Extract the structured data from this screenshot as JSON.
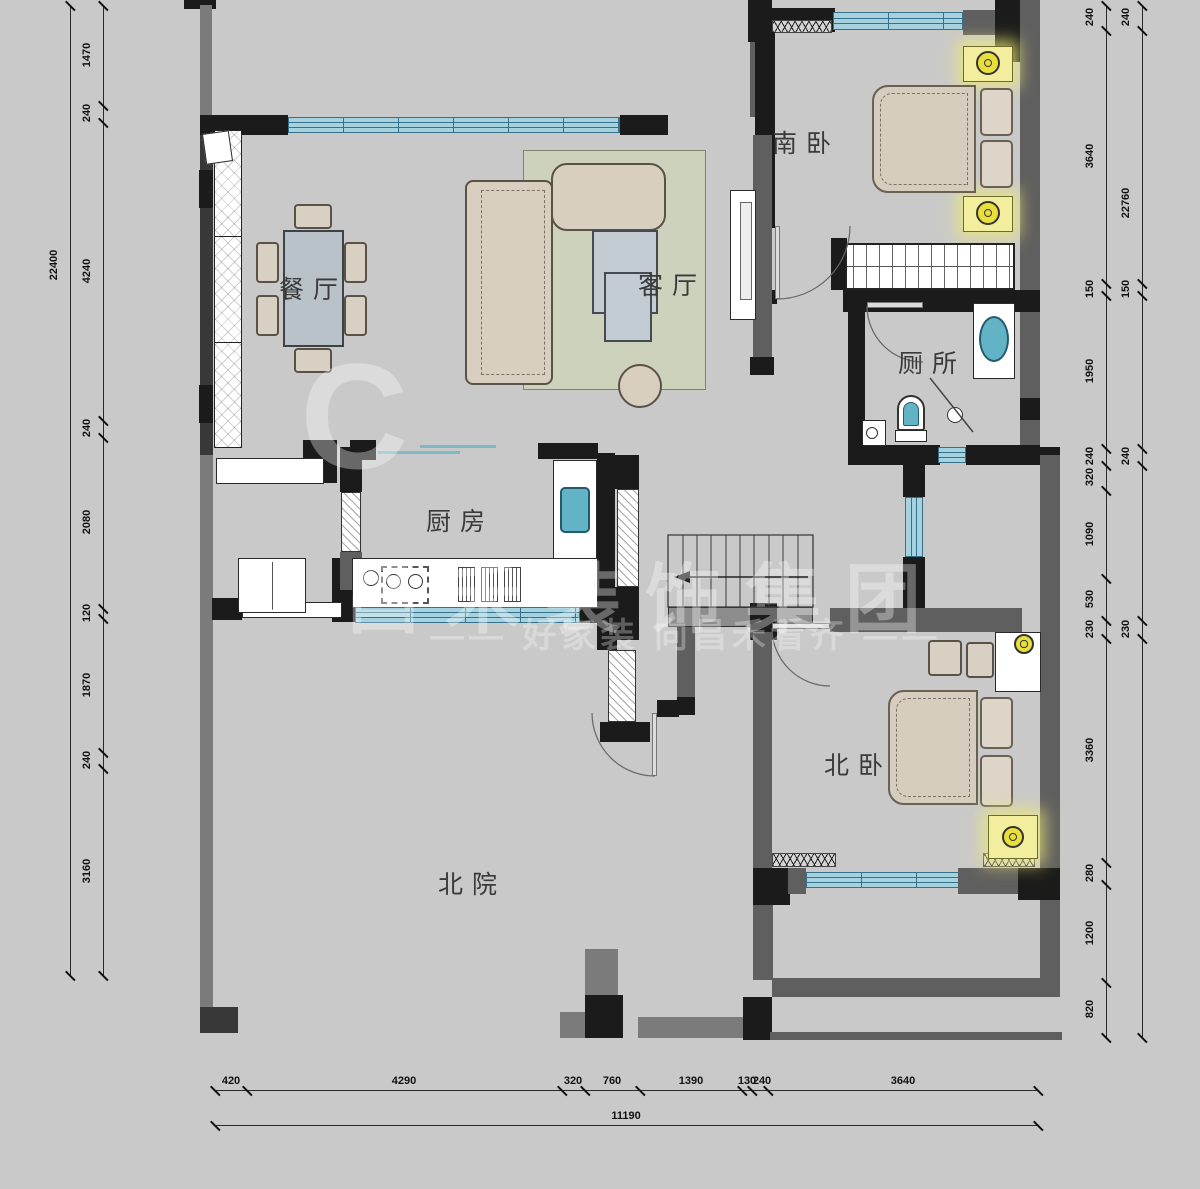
{
  "plan_title": "二层户型平面图",
  "background": "#c9c9c9",
  "colors": {
    "wall_black": "#1b1b1b",
    "wall_gray": "#6e6e6e",
    "window_fill": "#a5d2de",
    "window_line": "#35718a",
    "furniture_beige": "#d8d0c2",
    "rug_green": "#cdd2bc",
    "fixture_teal": "#62b3c6",
    "lamp_yellow": "#f3ee9e"
  },
  "rooms": [
    {
      "id": "dining",
      "label": "餐厅",
      "x": 313,
      "y": 288
    },
    {
      "id": "living",
      "label": "客厅",
      "x": 672,
      "y": 284
    },
    {
      "id": "south-bedroom",
      "label": "南卧",
      "x": 806,
      "y": 142
    },
    {
      "id": "toilet",
      "label": "厕所",
      "x": 932,
      "y": 362
    },
    {
      "id": "kitchen",
      "label": "厨房",
      "x": 460,
      "y": 520
    },
    {
      "id": "north-bedroom",
      "label": "北卧",
      "x": 858,
      "y": 764
    },
    {
      "id": "north-yard",
      "label": "北院",
      "x": 472,
      "y": 883
    }
  ],
  "watermark": {
    "brand": "昌禾装饰集团",
    "slogan": "—— 好家装 向昌禾看齐 ——",
    "mark": "C"
  },
  "dimensions": {
    "chains": [
      {
        "id": "left-total",
        "dir": "v",
        "line": 70,
        "start": 5,
        "end": 975,
        "ticks": [
          5,
          975
        ],
        "labels": [
          {
            "t": "22400",
            "p": 265
          }
        ]
      },
      {
        "id": "left-chain",
        "dir": "v",
        "line": 103,
        "start": 5,
        "end": 975,
        "ticks": [
          5,
          105,
          122,
          420,
          437,
          608,
          618,
          752,
          768,
          975
        ],
        "labels": [
          {
            "t": "1470",
            "p": 55
          },
          {
            "t": "240",
            "p": 113
          },
          {
            "t": "4240",
            "p": 271
          },
          {
            "t": "240",
            "p": 428
          },
          {
            "t": "2080",
            "p": 522
          },
          {
            "t": "120",
            "p": 613
          },
          {
            "t": "1870",
            "p": 685
          },
          {
            "t": "240",
            "p": 760
          },
          {
            "t": "3160",
            "p": 871
          }
        ]
      },
      {
        "id": "right-chain",
        "dir": "v",
        "line": 1106,
        "start": 5,
        "end": 1037,
        "ticks": [
          5,
          30,
          283,
          295,
          448,
          465,
          490,
          578,
          620,
          638,
          862,
          884,
          982,
          1037
        ],
        "labels": [
          {
            "t": "240",
            "p": 17
          },
          {
            "t": "3640",
            "p": 156
          },
          {
            "t": "150",
            "p": 289
          },
          {
            "t": "1950",
            "p": 371
          },
          {
            "t": "240",
            "p": 456
          },
          {
            "t": "320",
            "p": 477
          },
          {
            "t": "1090",
            "p": 534
          },
          {
            "t": "530",
            "p": 599
          },
          {
            "t": "230",
            "p": 629
          },
          {
            "t": "3360",
            "p": 750
          },
          {
            "t": "280",
            "p": 873
          },
          {
            "t": "1200",
            "p": 933
          },
          {
            "t": "820",
            "p": 1009
          }
        ]
      },
      {
        "id": "right-total",
        "dir": "v",
        "line": 1142,
        "start": 5,
        "end": 1037,
        "ticks": [
          5,
          30,
          283,
          295,
          448,
          465,
          620,
          638,
          1037
        ],
        "labels": [
          {
            "t": "240",
            "p": 17
          },
          {
            "t": "22760",
            "p": 203
          },
          {
            "t": "150",
            "p": 289
          },
          {
            "t": "240",
            "p": 456
          },
          {
            "t": "230",
            "p": 629
          }
        ]
      },
      {
        "id": "bottom-chain",
        "dir": "h",
        "line": 1090,
        "start": 215,
        "end": 1038,
        "ticks": [
          215,
          247,
          562,
          585,
          640,
          742,
          752,
          768,
          1038
        ],
        "labels": [
          {
            "t": "420",
            "p": 231
          },
          {
            "t": "4290",
            "p": 404
          },
          {
            "t": "320",
            "p": 573
          },
          {
            "t": "760",
            "p": 612
          },
          {
            "t": "1390",
            "p": 691
          },
          {
            "t": "130",
            "p": 747
          },
          {
            "t": "240",
            "p": 762
          },
          {
            "t": "3640",
            "p": 903
          }
        ]
      },
      {
        "id": "bottom-total",
        "dir": "h",
        "line": 1125,
        "start": 215,
        "end": 1038,
        "ticks": [
          215,
          1038
        ],
        "labels": [
          {
            "t": "11190",
            "p": 626
          }
        ]
      }
    ]
  }
}
